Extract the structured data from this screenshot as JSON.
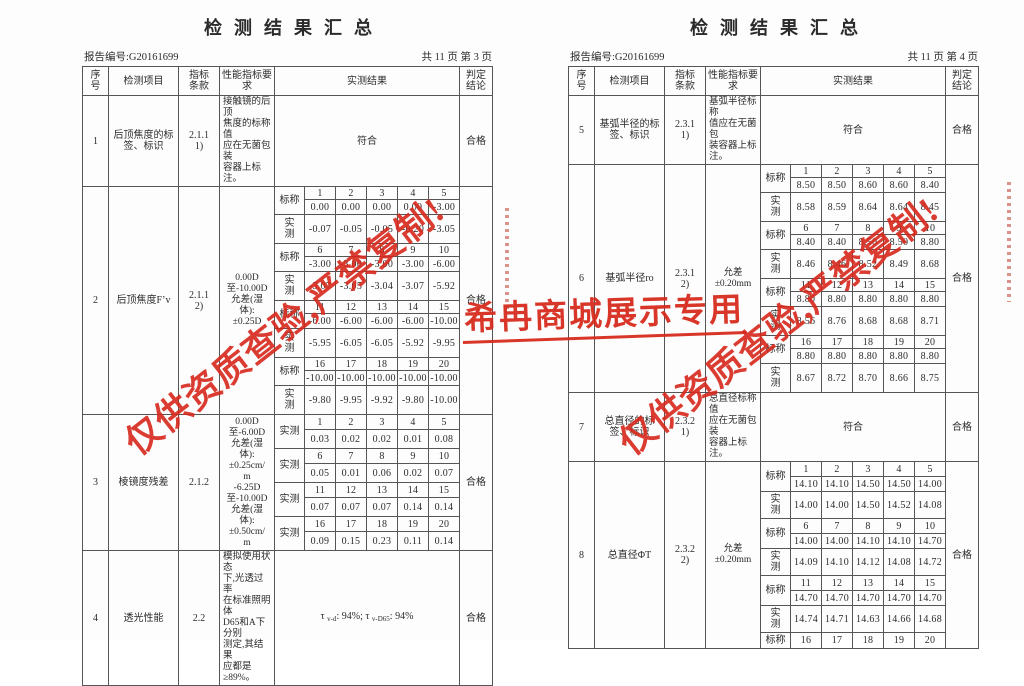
{
  "labels": {
    "nominal": "标称",
    "measured": "实测"
  },
  "watermarks": {
    "diagonal": "仅供资质查验,严禁复制!",
    "banner": "希冉商城展示专用",
    "color": "#d7281b"
  },
  "pages": [
    {
      "title": "检测结果汇总",
      "report_label": "报告编号:G20161699",
      "page_label": "共 11 页 第 3 页",
      "columns": [
        "序\n号",
        "检测项目",
        "指标\n条款",
        "性能指标要求",
        "实测结果",
        "判定\n结论"
      ],
      "rows": [
        {
          "no": "1",
          "item": "后顶焦度的标\n签、标识",
          "clause": "2.1.1\n1)",
          "spec": "接触镜的后顶\n焦度的标称值\n应在无菌包装\n容器上标注。",
          "result": {
            "type": "text",
            "text": "符合"
          },
          "verdict": "合格"
        },
        {
          "no": "2",
          "item": "后顶焦度F’v",
          "clause": "2.1.1\n2)",
          "spec": "0.00D\n至-10.00D\n允差(湿\n体):\n±0.25D",
          "result": {
            "type": "groups",
            "groups": [
              {
                "nums": [
                  "1",
                  "2",
                  "3",
                  "4",
                  "5"
                ],
                "nominal": [
                  "0.00",
                  "0.00",
                  "0.00",
                  "0.00",
                  "-3.00"
                ],
                "measured": [
                  "-0.07",
                  "-0.05",
                  "-0.05",
                  "-0.20",
                  "-3.05"
                ]
              },
              {
                "nums": [
                  "6",
                  "7",
                  "8",
                  "9",
                  "10"
                ],
                "nominal": [
                  "-3.00",
                  "-3.00",
                  "-3.00",
                  "-3.00",
                  "-6.00"
                ],
                "measured": [
                  "-3.07",
                  "-3.05",
                  "-3.04",
                  "-3.07",
                  "-5.92"
                ]
              },
              {
                "nums": [
                  "11",
                  "12",
                  "13",
                  "14",
                  "15"
                ],
                "nominal": [
                  "-6.00",
                  "-6.00",
                  "-6.00",
                  "-6.00",
                  "-10.00"
                ],
                "measured": [
                  "-5.95",
                  "-6.05",
                  "-6.05",
                  "-5.92",
                  "-9.95"
                ]
              },
              {
                "nums": [
                  "16",
                  "17",
                  "18",
                  "19",
                  "20"
                ],
                "nominal": [
                  "-10.00",
                  "-10.00",
                  "-10.00",
                  "-10.00",
                  "-10.00"
                ],
                "measured": [
                  "-9.80",
                  "-9.95",
                  "-9.92",
                  "-9.80",
                  "-10.00"
                ]
              }
            ]
          },
          "verdict": "合格"
        },
        {
          "no": "3",
          "item": "棱镜度残差",
          "clause": "2.1.2",
          "spec": "0.00D\n至-6.00D\n允差(湿\n体):\n±0.25cm/\nm\n-6.25D\n至-10.00D\n允差(湿\n体):\n±0.50cm/\nm",
          "result": {
            "type": "groups",
            "groups": [
              {
                "nums": [
                  "1",
                  "2",
                  "3",
                  "4",
                  "5"
                ],
                "measured": [
                  "0.03",
                  "0.02",
                  "0.02",
                  "0.01",
                  "0.08"
                ]
              },
              {
                "nums": [
                  "6",
                  "7",
                  "8",
                  "9",
                  "10"
                ],
                "measured": [
                  "0.05",
                  "0.01",
                  "0.06",
                  "0.02",
                  "0.07"
                ]
              },
              {
                "nums": [
                  "11",
                  "12",
                  "13",
                  "14",
                  "15"
                ],
                "measured": [
                  "0.07",
                  "0.07",
                  "0.07",
                  "0.14",
                  "0.14"
                ]
              },
              {
                "nums": [
                  "16",
                  "17",
                  "18",
                  "19",
                  "20"
                ],
                "measured": [
                  "0.09",
                  "0.15",
                  "0.23",
                  "0.11",
                  "0.14"
                ]
              }
            ]
          },
          "verdict": "合格"
        },
        {
          "no": "4",
          "item": "透光性能",
          "clause": "2.2",
          "spec": "模拟使用状态\n下,光透过率\n在标准照明体\nD65和A下分别\n测定,其结果\n应都是\n≥89%。",
          "result": {
            "type": "parts",
            "parts": [
              {
                "t": "τ "
              },
              {
                "sub": "v-d"
              },
              {
                "t": ": 94%; τ "
              },
              {
                "sub": "v-D65"
              },
              {
                "t": ": 94%"
              }
            ]
          },
          "verdict": "合格"
        }
      ]
    },
    {
      "title": "检测结果汇总",
      "report_label": "报告编号:G20161699",
      "page_label": "共 11 页 第 4 页",
      "columns": [
        "序\n号",
        "检测项目",
        "指标\n条款",
        "性能指标要求",
        "实测结果",
        "判定\n结论"
      ],
      "rows": [
        {
          "no": "5",
          "item": "基弧半径的标\n签、标识",
          "clause": "2.3.1\n1)",
          "spec": "基弧半径标称\n值应在无菌包\n装容器上标\n注。",
          "result": {
            "type": "text",
            "text": "符合"
          },
          "verdict": "合格"
        },
        {
          "no": "6",
          "item": "基弧半径ro",
          "clause": "2.3.1\n2)",
          "spec": "允差\n±0.20mm",
          "result": {
            "type": "groups",
            "groups": [
              {
                "nums": [
                  "1",
                  "2",
                  "3",
                  "4",
                  "5"
                ],
                "nominal": [
                  "8.50",
                  "8.50",
                  "8.60",
                  "8.60",
                  "8.40"
                ],
                "measured": [
                  "8.58",
                  "8.59",
                  "8.64",
                  "8.64",
                  "8.45"
                ]
              },
              {
                "nums": [
                  "6",
                  "7",
                  "8",
                  "9",
                  "10"
                ],
                "nominal": [
                  "8.40",
                  "8.40",
                  "8.50",
                  "8.50",
                  "8.80"
                ],
                "measured": [
                  "8.46",
                  "8.46",
                  "8.52",
                  "8.49",
                  "8.68"
                ]
              },
              {
                "nums": [
                  "11",
                  "12",
                  "13",
                  "14",
                  "15"
                ],
                "nominal": [
                  "8.80",
                  "8.80",
                  "8.80",
                  "8.80",
                  "8.80"
                ],
                "measured": [
                  "8.56",
                  "8.76",
                  "8.68",
                  "8.68",
                  "8.71"
                ]
              },
              {
                "nums": [
                  "16",
                  "17",
                  "18",
                  "19",
                  "20"
                ],
                "nominal": [
                  "8.80",
                  "8.80",
                  "8.80",
                  "8.80",
                  "8.80"
                ],
                "measured": [
                  "8.67",
                  "8.72",
                  "8.70",
                  "8.66",
                  "8.75"
                ]
              }
            ]
          },
          "verdict": "合格"
        },
        {
          "no": "7",
          "item": "总直径的标\n签、标识",
          "clause": "2.3.2\n1)",
          "spec": "总直径标称值\n应在无菌包装\n容器上标注。",
          "result": {
            "type": "text",
            "text": "符合"
          },
          "verdict": "合格"
        },
        {
          "no": "8",
          "item": "总直径ΦT",
          "clause": "2.3.2\n2)",
          "spec": "允差\n±0.20mm",
          "result": {
            "type": "groups",
            "groups": [
              {
                "nums": [
                  "1",
                  "2",
                  "3",
                  "4",
                  "5"
                ],
                "nominal": [
                  "14.10",
                  "14.10",
                  "14.50",
                  "14.50",
                  "14.00"
                ],
                "measured": [
                  "14.00",
                  "14.00",
                  "14.50",
                  "14.52",
                  "14.08"
                ]
              },
              {
                "nums": [
                  "6",
                  "7",
                  "8",
                  "9",
                  "10"
                ],
                "nominal": [
                  "14.00",
                  "14.00",
                  "14.10",
                  "14.10",
                  "14.70"
                ],
                "measured": [
                  "14.09",
                  "14.10",
                  "14.12",
                  "14.08",
                  "14.72"
                ]
              },
              {
                "nums": [
                  "11",
                  "12",
                  "13",
                  "14",
                  "15"
                ],
                "nominal": [
                  "14.70",
                  "14.70",
                  "14.70",
                  "14.70",
                  "14.70"
                ],
                "measured": [
                  "14.74",
                  "14.71",
                  "14.63",
                  "14.66",
                  "14.68"
                ]
              },
              {
                "nums": [
                  "16",
                  "17",
                  "18",
                  "19",
                  "20"
                ]
              }
            ]
          },
          "verdict": "合格"
        }
      ]
    }
  ]
}
